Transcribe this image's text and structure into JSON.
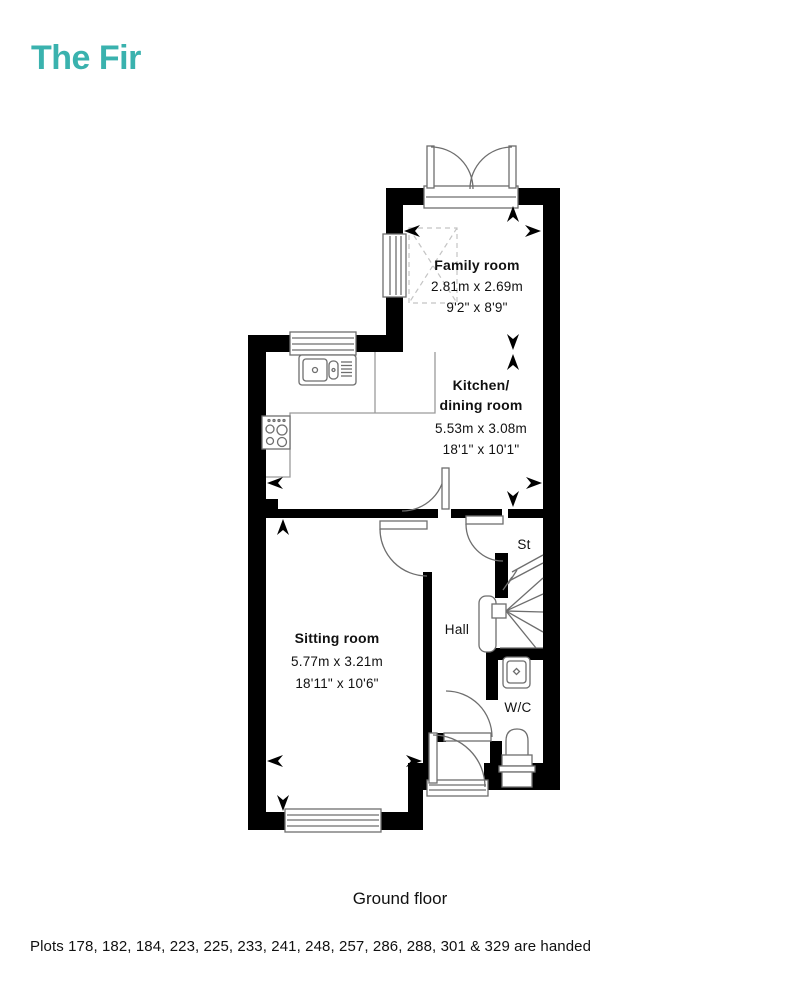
{
  "title": "The Fir",
  "accent_color": "#3AB2AE",
  "plan": {
    "rooms": [
      {
        "name": "Family room",
        "metric": "2.81m x 2.69m",
        "imperial": "9'2\" x 8'9\""
      },
      {
        "name_lines": [
          "Kitchen/",
          "dining room"
        ],
        "metric": "5.53m x 3.08m",
        "imperial": "18'1\" x 10'1\""
      },
      {
        "name": "Sitting room",
        "metric": "5.77m x 3.21m",
        "imperial": "18'11\" x 10'6\""
      },
      {
        "name": "Hall"
      },
      {
        "name": "St"
      },
      {
        "name": "W/C"
      }
    ]
  },
  "caption": "Ground floor",
  "footnote": "Plots 178, 182, 184, 223, 225, 233, 241, 248, 257, 286, 288, 301 & 329 are handed"
}
